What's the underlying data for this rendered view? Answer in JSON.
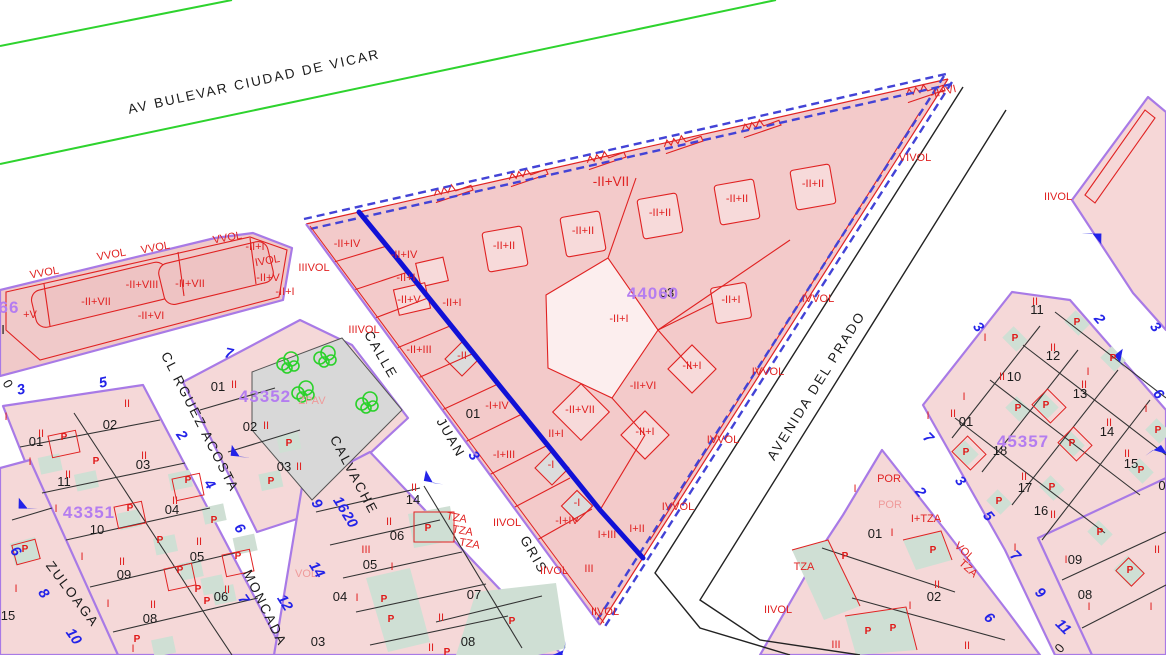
{
  "map": {
    "colors": {
      "parcel_fill": "#f5d8d8",
      "triangle_fill": "#f3caca",
      "building_fill": "#f7dada",
      "patio_teal": "#cfdfd4",
      "plaza_gray": "#d8d8d8",
      "boundary_purple": "#a87ae6",
      "line_red": "#e02222",
      "line_blue_thick": "#1111d6",
      "edge_blue_dashed": "#4343d6",
      "street_green": "#2ed32e",
      "road_black": "#222222",
      "parcel_id_violet": "#b47df0",
      "portal_blue": "#2323e8"
    },
    "streets": [
      {
        "t": "AV BULEVAR CIUDAD DE VICAR",
        "x": 255,
        "y": 86,
        "r": -12.5
      },
      {
        "t": "CL RGUEZ ACOSTA",
        "x": 196,
        "y": 424,
        "r": 63
      },
      {
        "t": "ZULOAGA",
        "x": 69,
        "y": 597,
        "r": 53
      },
      {
        "t": "MONCADA",
        "x": 261,
        "y": 610,
        "r": 64
      },
      {
        "t": "CALVACHE",
        "x": 350,
        "y": 477,
        "r": 62
      },
      {
        "t": "CALLE",
        "x": 377,
        "y": 357,
        "r": 60
      },
      {
        "t": "JUAN",
        "x": 447,
        "y": 440,
        "r": 60
      },
      {
        "t": "GRIS",
        "x": 530,
        "y": 557,
        "r": 60
      },
      {
        "t": "AVENIDA DEL PRADO",
        "x": 820,
        "y": 388,
        "r": -58
      }
    ],
    "parcel_ids": [
      {
        "t": "44060",
        "x": 653,
        "y": 299
      },
      {
        "t": "43352",
        "x": 265,
        "y": 402
      },
      {
        "t": "43351",
        "x": 89,
        "y": 518
      },
      {
        "t": "45357",
        "x": 1023,
        "y": 447
      },
      {
        "t": "66",
        "x": 9,
        "y": 313
      }
    ],
    "lot_numbers": [
      {
        "t": "03",
        "x": 667,
        "y": 297
      },
      {
        "t": "01",
        "x": 218,
        "y": 391
      },
      {
        "t": "02",
        "x": 250,
        "y": 431
      },
      {
        "t": "03",
        "x": 284,
        "y": 471
      },
      {
        "t": "01",
        "x": 36,
        "y": 446
      },
      {
        "t": "02",
        "x": 110,
        "y": 429
      },
      {
        "t": "03",
        "x": 143,
        "y": 469
      },
      {
        "t": "11",
        "x": 64,
        "y": 486
      },
      {
        "t": "10",
        "x": 97,
        "y": 534
      },
      {
        "t": "04",
        "x": 172,
        "y": 514
      },
      {
        "t": "09",
        "x": 124,
        "y": 579
      },
      {
        "t": "05",
        "x": 197,
        "y": 561
      },
      {
        "t": "08",
        "x": 150,
        "y": 623
      },
      {
        "t": "06",
        "x": 221,
        "y": 601
      },
      {
        "t": "15",
        "x": 8,
        "y": 620
      },
      {
        "t": "14",
        "x": 413,
        "y": 504
      },
      {
        "t": "06",
        "x": 397,
        "y": 540
      },
      {
        "t": "05",
        "x": 370,
        "y": 569
      },
      {
        "t": "04",
        "x": 340,
        "y": 601
      },
      {
        "t": "03",
        "x": 318,
        "y": 646
      },
      {
        "t": "07",
        "x": 474,
        "y": 599
      },
      {
        "t": "08",
        "x": 468,
        "y": 646
      },
      {
        "t": "01",
        "x": 473,
        "y": 418
      },
      {
        "t": "11",
        "x": 1037,
        "y": 314
      },
      {
        "t": "12",
        "x": 1053,
        "y": 360
      },
      {
        "t": "10",
        "x": 1014,
        "y": 381
      },
      {
        "t": "13",
        "x": 1080,
        "y": 398
      },
      {
        "t": "01",
        "x": 966,
        "y": 426
      },
      {
        "t": "14",
        "x": 1107,
        "y": 436
      },
      {
        "t": "18",
        "x": 1000,
        "y": 455
      },
      {
        "t": "15",
        "x": 1131,
        "y": 468
      },
      {
        "t": "17",
        "x": 1025,
        "y": 492
      },
      {
        "t": "16",
        "x": 1041,
        "y": 515
      },
      {
        "t": "0",
        "x": 1162,
        "y": 490
      },
      {
        "t": "01",
        "x": 875,
        "y": 538
      },
      {
        "t": "02",
        "x": 934,
        "y": 601
      },
      {
        "t": "09",
        "x": 1075,
        "y": 564
      },
      {
        "t": "08",
        "x": 1085,
        "y": 599
      }
    ],
    "fragments": [
      {
        "t": "0",
        "x": 4,
        "y": 386,
        "r": 60
      },
      {
        "t": "0",
        "x": 1063,
        "y": 651,
        "r": -50
      },
      {
        "t": "I",
        "x": 3,
        "y": 334,
        "r": 0
      }
    ],
    "codes": [
      {
        "t": "-II+VII",
        "x": 611,
        "y": 186,
        "k": "cbig"
      },
      {
        "t": "-II+II",
        "x": 504,
        "y": 249
      },
      {
        "t": "-II+II",
        "x": 583,
        "y": 234
      },
      {
        "t": "-II+II",
        "x": 660,
        "y": 216
      },
      {
        "t": "-II+II",
        "x": 737,
        "y": 202
      },
      {
        "t": "-II+II",
        "x": 813,
        "y": 187
      },
      {
        "t": "-II+I",
        "x": 619,
        "y": 322
      },
      {
        "t": "-II+I",
        "x": 731,
        "y": 303
      },
      {
        "t": "-II+I",
        "x": 692,
        "y": 369
      },
      {
        "t": "-II+VI",
        "x": 643,
        "y": 389
      },
      {
        "t": "-II+VII",
        "x": 580,
        "y": 413
      },
      {
        "t": "-II+I",
        "x": 645,
        "y": 435
      },
      {
        "t": "-II+IV",
        "x": 347,
        "y": 247
      },
      {
        "t": "-II+IV",
        "x": 404,
        "y": 258
      },
      {
        "t": "-II+I",
        "x": 406,
        "y": 281
      },
      {
        "t": "-II+V",
        "x": 409,
        "y": 303
      },
      {
        "t": "-II+I",
        "x": 452,
        "y": 306
      },
      {
        "t": "IIIVOL",
        "x": 314,
        "y": 271
      },
      {
        "t": "IIIVOL",
        "x": 364,
        "y": 333
      },
      {
        "t": "-II+III",
        "x": 419,
        "y": 353
      },
      {
        "t": "-II",
        "x": 462,
        "y": 359
      },
      {
        "t": "-I+IV",
        "x": 497,
        "y": 409
      },
      {
        "t": "II+I",
        "x": 556,
        "y": 437
      },
      {
        "t": "-I+III",
        "x": 504,
        "y": 458
      },
      {
        "t": "-I",
        "x": 551,
        "y": 468
      },
      {
        "t": "-I",
        "x": 577,
        "y": 506
      },
      {
        "t": "-I+IV",
        "x": 567,
        "y": 524
      },
      {
        "t": "I+III",
        "x": 607,
        "y": 538
      },
      {
        "t": "I+II",
        "x": 637,
        "y": 532
      },
      {
        "t": "IIVOL",
        "x": 507,
        "y": 526
      },
      {
        "t": "TZA",
        "x": 456,
        "y": 521,
        "r": 10
      },
      {
        "t": "TZA",
        "x": 462,
        "y": 534,
        "r": 10
      },
      {
        "t": "TZA",
        "x": 469,
        "y": 547,
        "r": 10
      },
      {
        "t": "IIVOL",
        "x": 554,
        "y": 574
      },
      {
        "t": "III",
        "x": 589,
        "y": 572
      },
      {
        "t": "IIVOL",
        "x": 605,
        "y": 615
      },
      {
        "t": "VIVOL",
        "x": 915,
        "y": 161
      },
      {
        "t": "-II+VI",
        "x": 944,
        "y": 95,
        "r": -14
      },
      {
        "t": "IVVOL",
        "x": 818,
        "y": 302
      },
      {
        "t": "IVVOL",
        "x": 768,
        "y": 375
      },
      {
        "t": "IVVOL",
        "x": 723,
        "y": 443
      },
      {
        "t": "IVVOL",
        "x": 678,
        "y": 510
      },
      {
        "t": "VVOL",
        "x": 45,
        "y": 276,
        "r": -10
      },
      {
        "t": "VVOL",
        "x": 112,
        "y": 258,
        "r": -10
      },
      {
        "t": "VVOL",
        "x": 156,
        "y": 251,
        "r": -10
      },
      {
        "t": "VVOL",
        "x": 228,
        "y": 241,
        "r": -10
      },
      {
        "t": "IVOL",
        "x": 268,
        "y": 264,
        "r": -10
      },
      {
        "t": "-II+VII",
        "x": 96,
        "y": 305
      },
      {
        "t": "-II+VIII",
        "x": 142,
        "y": 288
      },
      {
        "t": "-II+VII",
        "x": 190,
        "y": 287
      },
      {
        "t": "-II+VI",
        "x": 151,
        "y": 319
      },
      {
        "t": "-II+V",
        "x": 268,
        "y": 281
      },
      {
        "t": "-II+I",
        "x": 285,
        "y": 295
      },
      {
        "t": "-II+I",
        "x": 255,
        "y": 250
      },
      {
        "t": "+V",
        "x": 30,
        "y": 318
      },
      {
        "t": "IIVOL",
        "x": 1058,
        "y": 200
      },
      {
        "t": "POR",
        "x": 889,
        "y": 482
      },
      {
        "t": "POR",
        "x": 890,
        "y": 508,
        "k": "clight"
      },
      {
        "t": "I+TZA",
        "x": 926,
        "y": 522
      },
      {
        "t": "TZA",
        "x": 804,
        "y": 570
      },
      {
        "t": "IIVOL",
        "x": 778,
        "y": 613
      },
      {
        "t": "III",
        "x": 836,
        "y": 648
      },
      {
        "t": "VOL",
        "x": 962,
        "y": 554,
        "r": 42
      },
      {
        "t": "TZA",
        "x": 966,
        "y": 571,
        "r": 42
      },
      {
        "t": "ZPAV",
        "x": 312,
        "y": 404,
        "k": "clight"
      },
      {
        "t": "VOL",
        "x": 306,
        "y": 577,
        "k": "clight"
      },
      {
        "t": "II",
        "x": 234,
        "y": 388
      },
      {
        "t": "II",
        "x": 266,
        "y": 429
      },
      {
        "t": "II",
        "x": 299,
        "y": 470
      },
      {
        "t": "II",
        "x": 41,
        "y": 437
      },
      {
        "t": "II",
        "x": 127,
        "y": 407
      },
      {
        "t": "II",
        "x": 144,
        "y": 459
      },
      {
        "t": "II",
        "x": 68,
        "y": 478
      },
      {
        "t": "II",
        "x": 175,
        "y": 504
      },
      {
        "t": "II",
        "x": 122,
        "y": 565
      },
      {
        "t": "II",
        "x": 199,
        "y": 545
      },
      {
        "t": "II",
        "x": 153,
        "y": 608
      },
      {
        "t": "II",
        "x": 227,
        "y": 593
      },
      {
        "t": "I",
        "x": 6,
        "y": 420
      },
      {
        "t": "I",
        "x": 30,
        "y": 465
      },
      {
        "t": "I",
        "x": 56,
        "y": 512
      },
      {
        "t": "I",
        "x": 82,
        "y": 560
      },
      {
        "t": "I",
        "x": 108,
        "y": 607
      },
      {
        "t": "I",
        "x": 133,
        "y": 652
      },
      {
        "t": "II",
        "x": 414,
        "y": 491
      },
      {
        "t": "II",
        "x": 389,
        "y": 525
      },
      {
        "t": "III",
        "x": 366,
        "y": 553
      },
      {
        "t": "I",
        "x": 392,
        "y": 570
      },
      {
        "t": "I",
        "x": 357,
        "y": 601
      },
      {
        "t": "II",
        "x": 441,
        "y": 621
      },
      {
        "t": "II",
        "x": 431,
        "y": 651
      },
      {
        "t": "II",
        "x": 1035,
        "y": 305
      },
      {
        "t": "II",
        "x": 1053,
        "y": 351
      },
      {
        "t": "II",
        "x": 1002,
        "y": 380
      },
      {
        "t": "II",
        "x": 1084,
        "y": 388
      },
      {
        "t": "II",
        "x": 953,
        "y": 417
      },
      {
        "t": "II",
        "x": 1109,
        "y": 426
      },
      {
        "t": "II",
        "x": 1127,
        "y": 457
      },
      {
        "t": "II",
        "x": 1024,
        "y": 480
      },
      {
        "t": "II",
        "x": 1053,
        "y": 518
      },
      {
        "t": "I",
        "x": 985,
        "y": 341
      },
      {
        "t": "I",
        "x": 928,
        "y": 419
      },
      {
        "t": "I",
        "x": 964,
        "y": 400
      },
      {
        "t": "I",
        "x": 1146,
        "y": 412
      },
      {
        "t": "I",
        "x": 1088,
        "y": 375
      },
      {
        "t": "I",
        "x": 1015,
        "y": 551
      },
      {
        "t": "I",
        "x": 892,
        "y": 536
      },
      {
        "t": "I",
        "x": 910,
        "y": 609
      },
      {
        "t": "I",
        "x": 855,
        "y": 492
      },
      {
        "t": "II",
        "x": 937,
        "y": 588
      },
      {
        "t": "II",
        "x": 1157,
        "y": 553
      },
      {
        "t": "I",
        "x": 1151,
        "y": 610
      },
      {
        "t": "I",
        "x": 1066,
        "y": 563
      },
      {
        "t": "I",
        "x": 1089,
        "y": 610
      },
      {
        "t": "II",
        "x": 967,
        "y": 649
      },
      {
        "t": "I",
        "x": 16,
        "y": 592
      }
    ],
    "p_marks": [
      {
        "x": 64,
        "y": 440
      },
      {
        "x": 96,
        "y": 464
      },
      {
        "x": 130,
        "y": 511
      },
      {
        "x": 160,
        "y": 543
      },
      {
        "x": 180,
        "y": 573
      },
      {
        "x": 207,
        "y": 604
      },
      {
        "x": 137,
        "y": 642
      },
      {
        "x": 188,
        "y": 483
      },
      {
        "x": 214,
        "y": 523
      },
      {
        "x": 238,
        "y": 559
      },
      {
        "x": 198,
        "y": 592
      },
      {
        "x": 289,
        "y": 446
      },
      {
        "x": 271,
        "y": 484
      },
      {
        "x": 384,
        "y": 602
      },
      {
        "x": 391,
        "y": 622
      },
      {
        "x": 512,
        "y": 624
      },
      {
        "x": 447,
        "y": 655
      },
      {
        "x": 428,
        "y": 531
      },
      {
        "x": 1015,
        "y": 341
      },
      {
        "x": 1077,
        "y": 325
      },
      {
        "x": 1113,
        "y": 361
      },
      {
        "x": 1046,
        "y": 408
      },
      {
        "x": 1018,
        "y": 411
      },
      {
        "x": 966,
        "y": 455
      },
      {
        "x": 1072,
        "y": 446
      },
      {
        "x": 1052,
        "y": 490
      },
      {
        "x": 1141,
        "y": 473
      },
      {
        "x": 999,
        "y": 504
      },
      {
        "x": 1100,
        "y": 535
      },
      {
        "x": 1158,
        "y": 433
      },
      {
        "x": 845,
        "y": 559
      },
      {
        "x": 933,
        "y": 553
      },
      {
        "x": 868,
        "y": 634
      },
      {
        "x": 893,
        "y": 631
      },
      {
        "x": 1130,
        "y": 573
      },
      {
        "x": 25,
        "y": 552
      }
    ],
    "portals": [
      {
        "t": "7",
        "x": 228,
        "y": 358,
        "r": 12
      },
      {
        "t": "3",
        "x": 22,
        "y": 394,
        "r": -12
      },
      {
        "t": "5",
        "x": 104,
        "y": 387,
        "r": -12
      },
      {
        "t": "2",
        "x": 178,
        "y": 438,
        "r": 55
      },
      {
        "t": "4",
        "x": 206,
        "y": 487,
        "r": 55
      },
      {
        "t": "6",
        "x": 236,
        "y": 531,
        "r": 55
      },
      {
        "t": "7",
        "x": 240,
        "y": 602,
        "r": 55
      },
      {
        "t": "6",
        "x": 12,
        "y": 554,
        "r": 55
      },
      {
        "t": "8",
        "x": 40,
        "y": 596,
        "r": 55
      },
      {
        "t": "10",
        "x": 70,
        "y": 639,
        "r": 55
      },
      {
        "t": "9",
        "x": 313,
        "y": 506,
        "r": 58
      },
      {
        "t": "16",
        "x": 337,
        "y": 507,
        "r": 58
      },
      {
        "t": "20",
        "x": 346,
        "y": 522,
        "r": 58
      },
      {
        "t": "14",
        "x": 313,
        "y": 572,
        "r": 58
      },
      {
        "t": "12",
        "x": 281,
        "y": 605,
        "r": 58
      },
      {
        "t": "3",
        "x": 470,
        "y": 458,
        "r": 58
      },
      {
        "t": "2",
        "x": 917,
        "y": 495,
        "r": 50
      },
      {
        "t": "3",
        "x": 957,
        "y": 484,
        "r": 50
      },
      {
        "t": "5",
        "x": 985,
        "y": 519,
        "r": 50
      },
      {
        "t": "3",
        "x": 975,
        "y": 330,
        "r": 50
      },
      {
        "t": "2",
        "x": 1096,
        "y": 322,
        "r": 50
      },
      {
        "t": "3",
        "x": 1152,
        "y": 330,
        "r": 50
      },
      {
        "t": "6",
        "x": 1155,
        "y": 397,
        "r": 50
      },
      {
        "t": "7",
        "x": 925,
        "y": 441,
        "r": 45
      },
      {
        "t": "7",
        "x": 1012,
        "y": 559,
        "r": 45
      },
      {
        "t": "9",
        "x": 1037,
        "y": 596,
        "r": 45
      },
      {
        "t": "6",
        "x": 986,
        "y": 621,
        "r": 45
      },
      {
        "t": "11",
        "x": 1060,
        "y": 630,
        "r": 45
      }
    ],
    "arrows": [
      {
        "x": 433,
        "y": 483,
        "r": 225
      },
      {
        "x": 1092,
        "y": 233,
        "r": 35
      },
      {
        "x": 1120,
        "y": 363,
        "r": 265
      },
      {
        "x": 240,
        "y": 457,
        "r": 220
      },
      {
        "x": 564,
        "y": 650,
        "r": 140
      },
      {
        "x": 28,
        "y": 509,
        "r": 215
      },
      {
        "x": 1153,
        "y": 450,
        "r": 0
      }
    ],
    "trees": [
      {
        "x": 288,
        "y": 362
      },
      {
        "x": 325,
        "y": 356
      },
      {
        "x": 367,
        "y": 402
      },
      {
        "x": 303,
        "y": 391
      }
    ]
  }
}
